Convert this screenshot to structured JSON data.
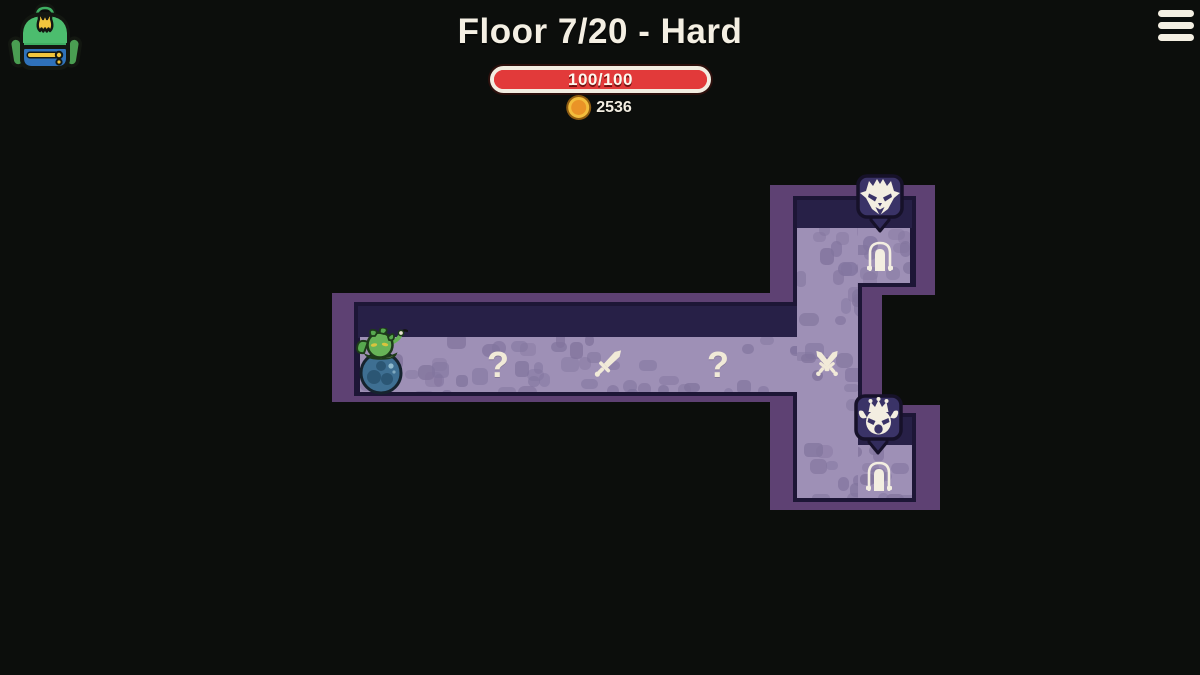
{
  "header": {
    "title": "Floor 7/20 - Hard",
    "health_label": "100/100",
    "health_current": 100,
    "health_max": 100,
    "coin_count": "2536"
  },
  "icons": {
    "backpack": "backpack-icon",
    "menu": "hamburger-menu-icon",
    "coin": "coin-icon"
  },
  "map": {
    "player": {
      "name": "player-character"
    },
    "path_nodes": [
      {
        "id": "node-1",
        "kind": "unknown",
        "glyph": "?"
      },
      {
        "id": "node-2",
        "kind": "battle",
        "icon": "sword-icon"
      },
      {
        "id": "node-3",
        "kind": "unknown",
        "glyph": "?"
      },
      {
        "id": "node-4",
        "kind": "elite-battle",
        "icon": "crossed-swords-icon"
      }
    ],
    "exits": [
      {
        "id": "exit-top",
        "icon": "door-icon",
        "badge_icon": "horned-beast-icon"
      },
      {
        "id": "exit-bottom",
        "icon": "door-icon",
        "badge_icon": "crowned-imp-icon"
      }
    ]
  },
  "colors": {
    "background": "#0c0e0c",
    "health_bar_red": "#e23a3a",
    "coin_gold": "#ea9327",
    "wall_purple": "#5e4173",
    "wall_navy": "#272047",
    "floor_light": "#9e90b6",
    "floor_stone": "#82759e",
    "badge_navy": "#3a3367",
    "cream": "#f3eee1"
  }
}
